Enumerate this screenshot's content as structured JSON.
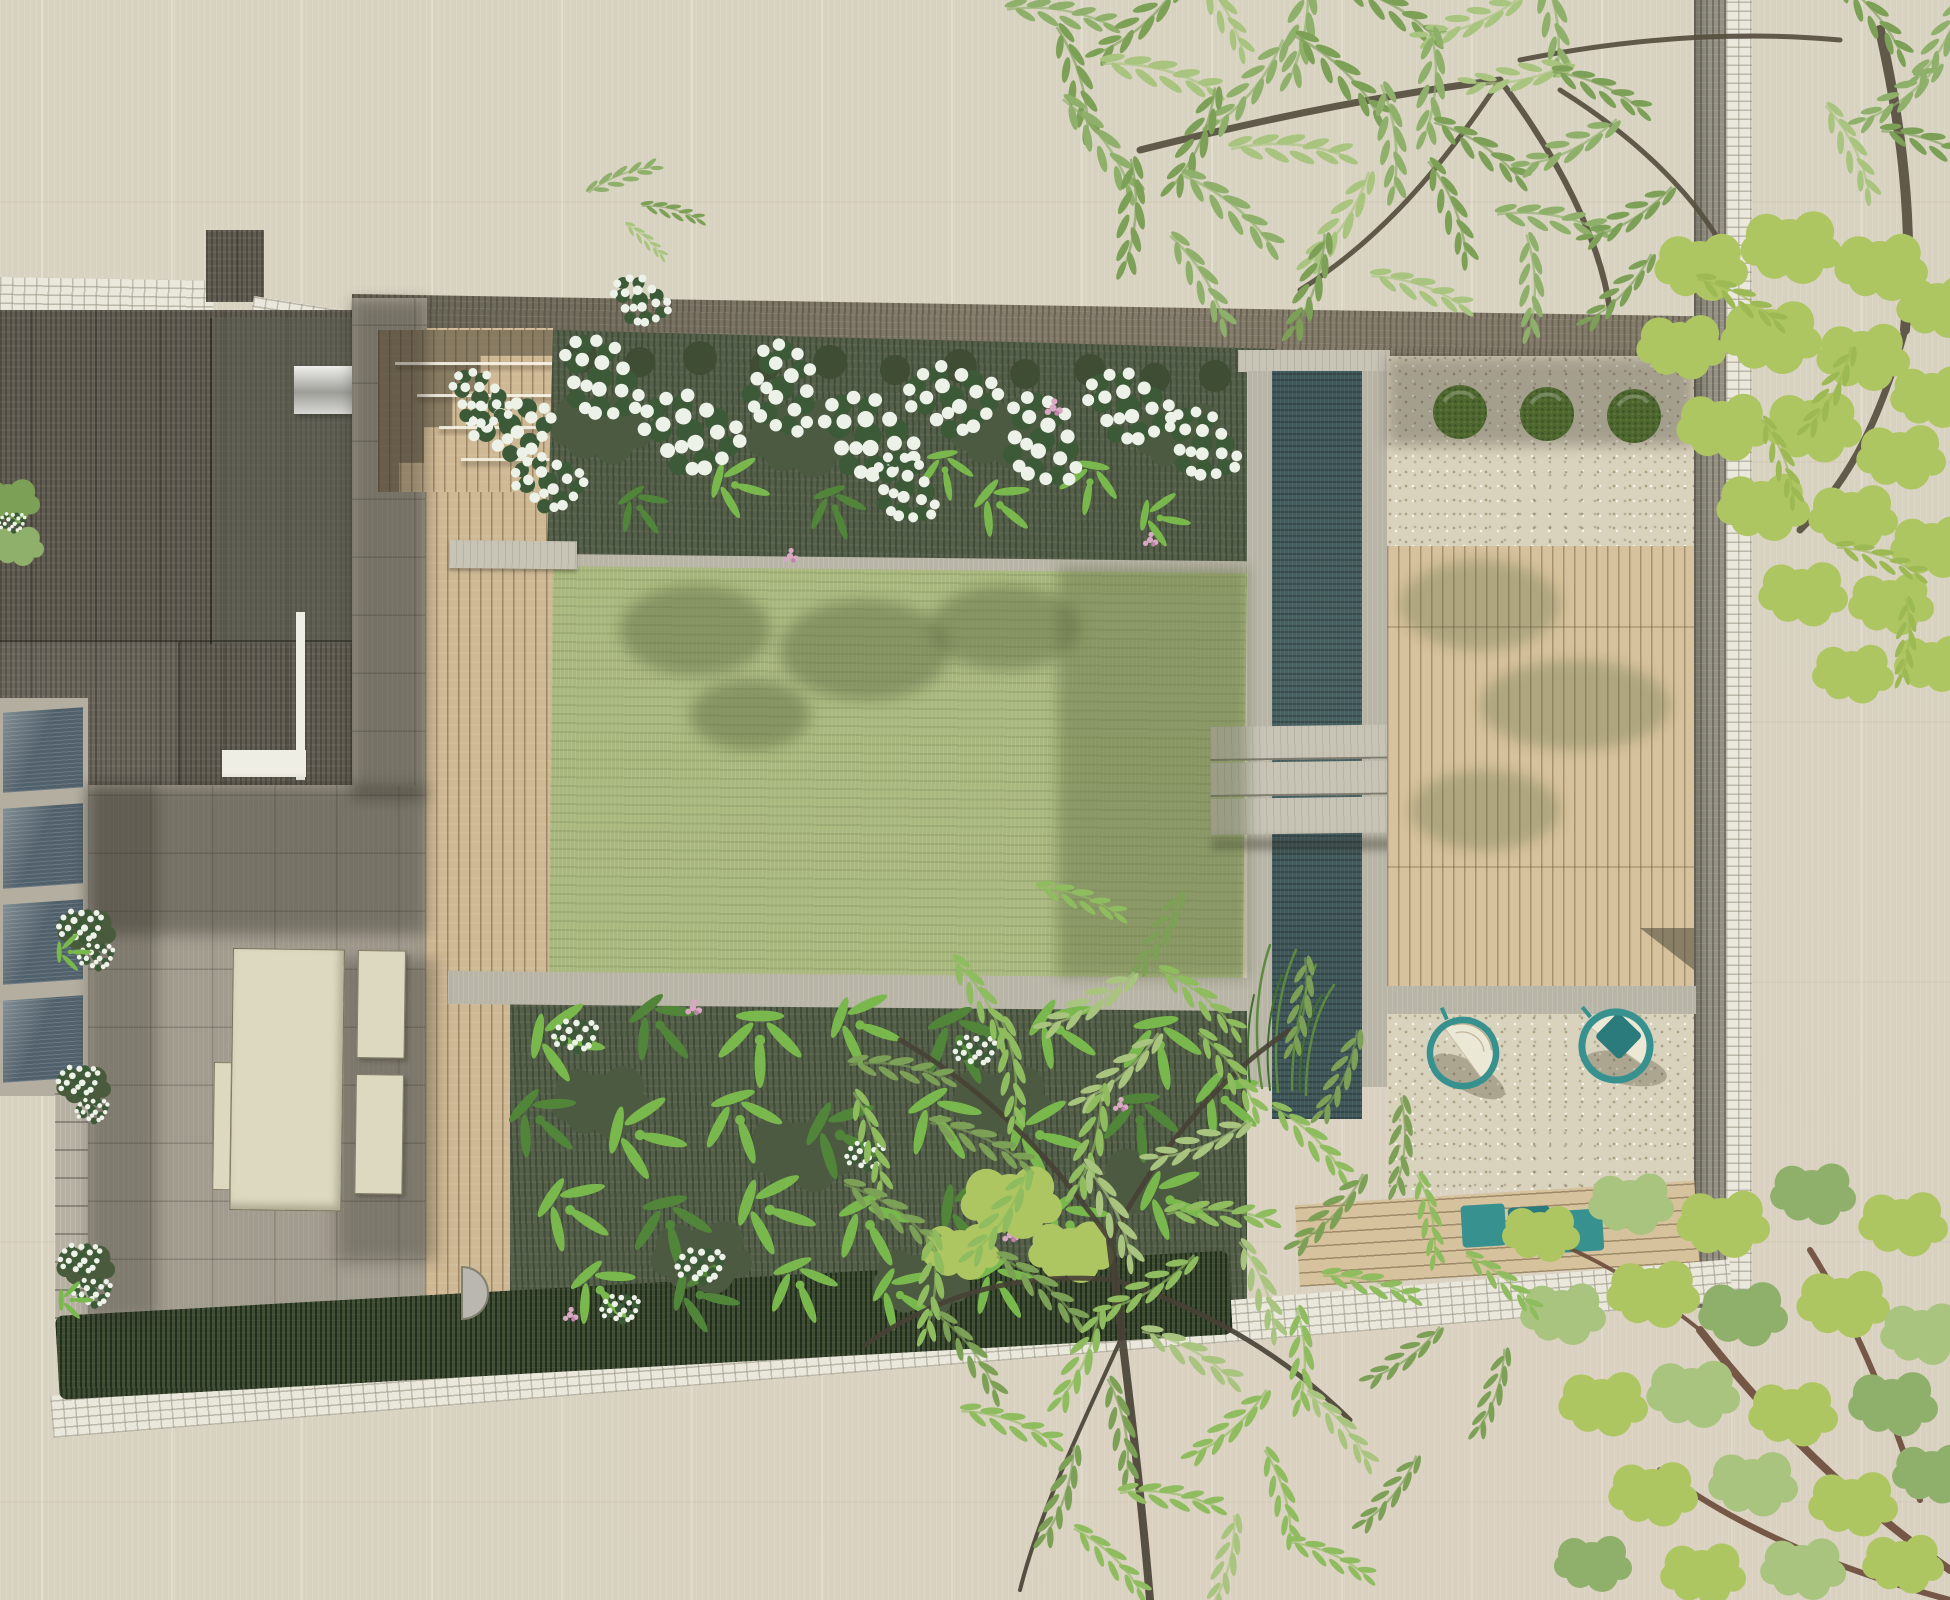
{
  "meta": {
    "artwork": "residential-garden-landscape-plan",
    "view": "top-down site plan rendering",
    "visible_text": "none"
  },
  "palette": {
    "paper": "#d8d2c0",
    "brickwhite": "#eae8dc",
    "wallband": "#88806f",
    "neighborwall": "#9b968a",
    "roof": "#625d52",
    "roofplane": "#5c6053",
    "patio": "#a29c8e",
    "deck": "#cfb994",
    "deckright": "#d6c29c",
    "lawn": "#a9b87e",
    "beddark": "#55604a",
    "hedge": "#3f4d35",
    "fern": "#79b84c",
    "ferndark": "#51853a",
    "blossomleaf": "#3c5a38",
    "blossomwhite": "#edf2e8",
    "pink": "#d9a8c4",
    "rill": "#40585a",
    "stone": "#b8b4a6",
    "slab": "#c7c3b5",
    "gravel": "#d9d2bc",
    "topiary": "#4e672f",
    "teal": "#37918f",
    "tealdark": "#2b7b7c",
    "cream": "#dcd9c0",
    "metal": "#c9c9c6",
    "glass": "#51616b",
    "glassframe": "#b3aea0",
    "branchtop": "#564f40",
    "branchlow": "#474135",
    "branchred": "#6b4a3a",
    "green1": "#8fb06a",
    "green2": "#7da057",
    "green3": "#a8c47e",
    "green4": "#8fbc5e",
    "yellowgreen": "#aec662"
  },
  "scene": {
    "house": [
      "main-roof",
      "dormer",
      "metal-flue",
      "rooflight-strip",
      "glazed-side-return"
    ],
    "hardscape": [
      "white-brick-party-walls",
      "top-garden-wall",
      "patio-paving",
      "left-deck-boardwalk",
      "deck-steps",
      "stone-landing",
      "stone-path",
      "right-deck",
      "gravel-terrace-top",
      "gravel-sitting-area",
      "bench-deck-band",
      "left-access-steps"
    ],
    "planting": [
      "top-bed-white-blossom-and-ferns",
      "bottom-bed-ferns-white-pink-flowers",
      "boundary-hedge",
      "three-clipped-topiary-balls",
      "wall-planters-white-flowers",
      "rill-grasses"
    ],
    "water": [
      "rill-channel",
      "three-slab-bridge"
    ],
    "lawn": [
      "central-lawn-with-tree-shadows"
    ],
    "trees": [
      "large-tree-top-right",
      "yellow-green-tree-right",
      "willow-tree-bottom-center",
      "tree-bottom-right"
    ],
    "furniture": {
      "dining_table": 1,
      "dining_benches": 3,
      "hanging_egg_chairs": 2,
      "teal_bench_cushions": 3
    }
  }
}
